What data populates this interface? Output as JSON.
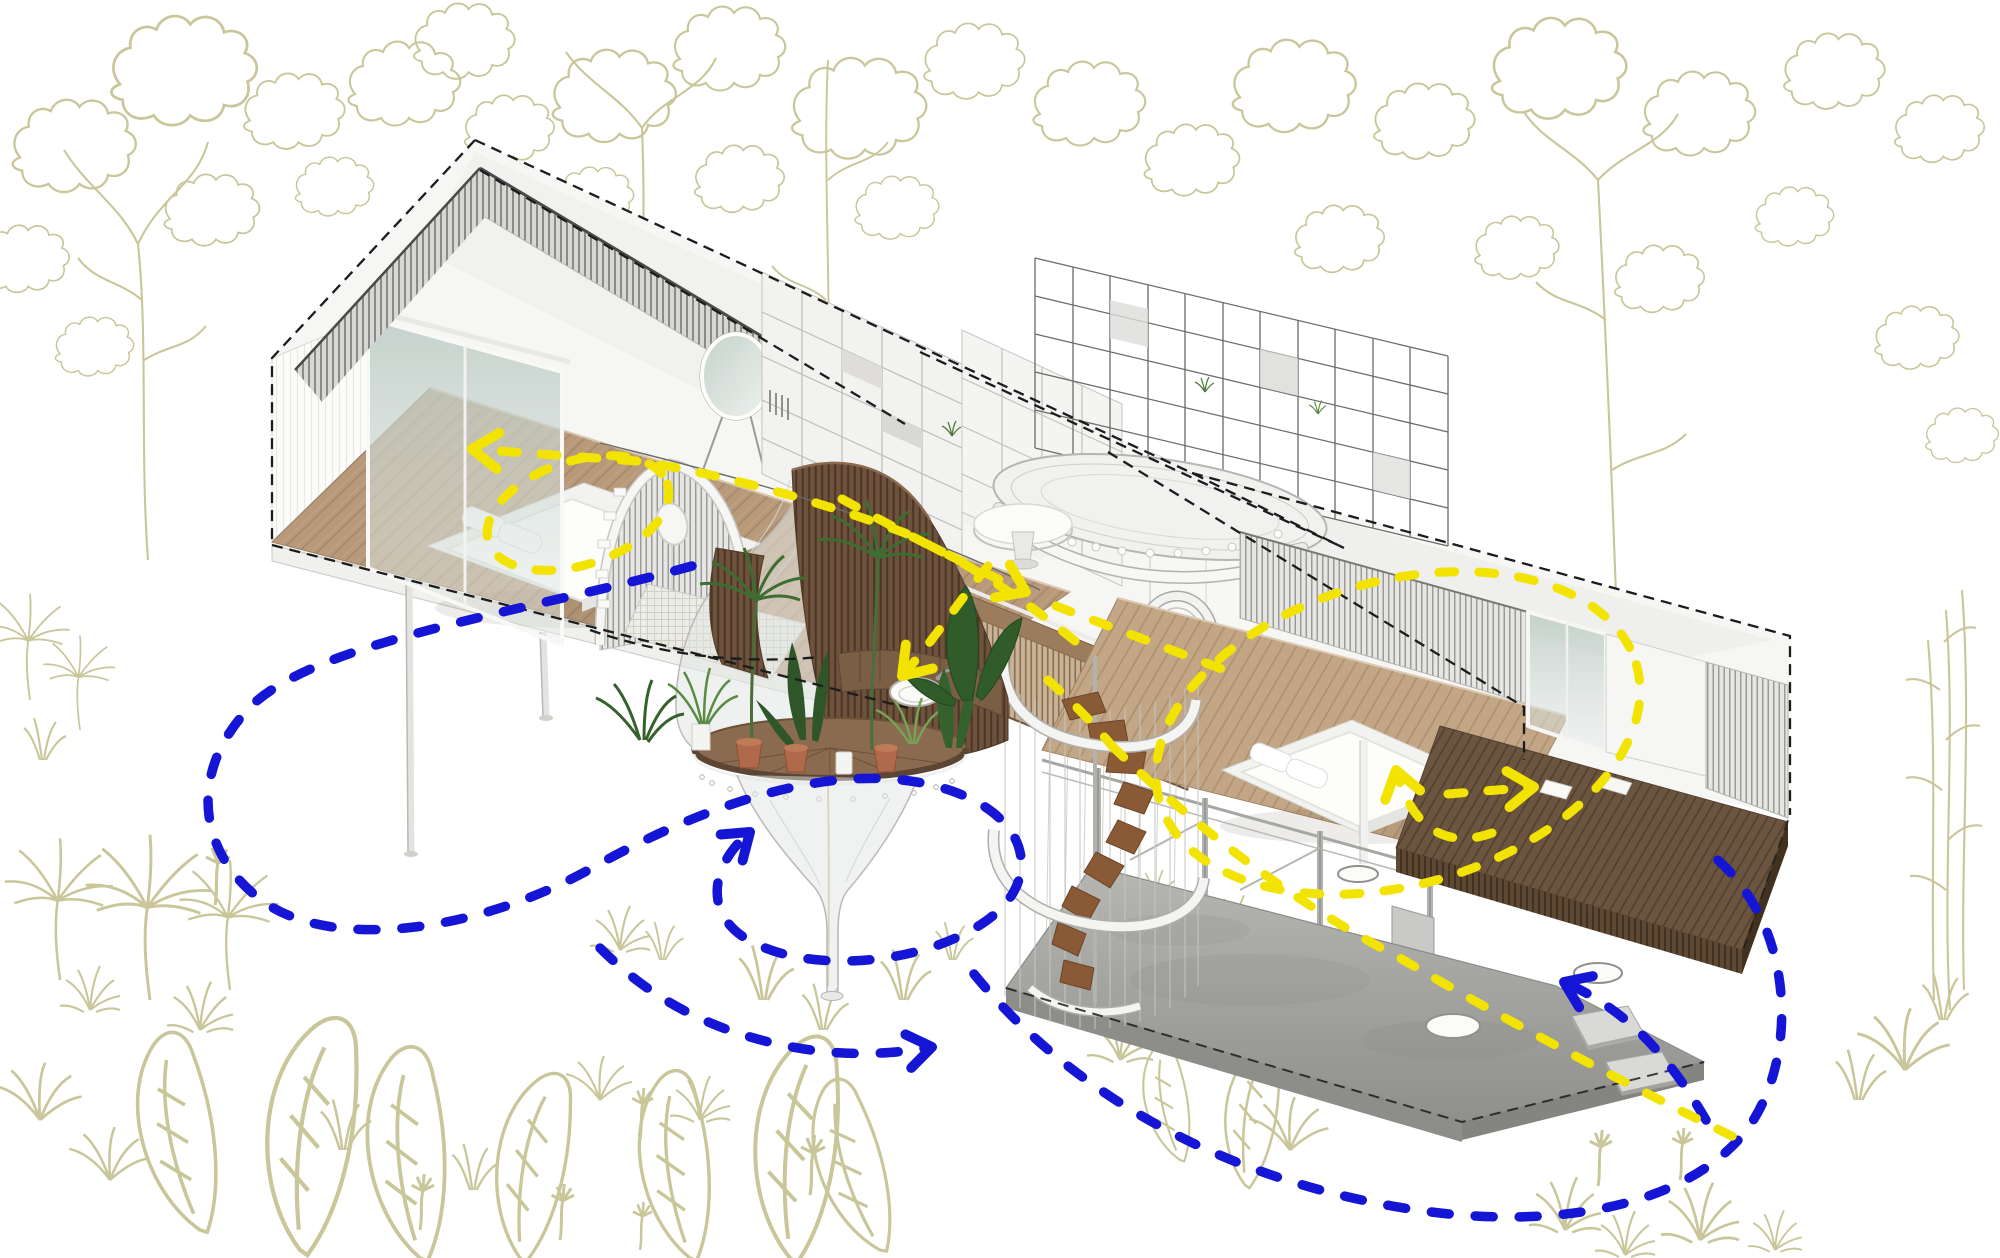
{
  "meta": {
    "domain": "architectural-axonometric-diagram",
    "description": "Axonometric cutaway of a two-wing tropical stilt house in a line-drawn forest, with dashed circulation and airflow paths"
  },
  "colors": {
    "background": "#ffffff",
    "foliage": "#c9c69a",
    "circulation": "#f2e400",
    "airflow": "#1515d6",
    "cut_outline": "#1c1c1c",
    "wall": "#f5f5f4",
    "glass": "#c9d6d0",
    "floor_wood": "#b89a7b",
    "floor_wood_right": "#c2a685",
    "deck_dark": "#6b5540",
    "slat_wood": "#6e523c",
    "fence_wood": "#c9b295",
    "concrete": "#a9a9a6",
    "plant_dark": "#2e5628",
    "plant_mid": "#4c7c3a",
    "plant_light": "#76a355",
    "terracotta": "#b06a4b",
    "stair_tread": "#8a5a36",
    "metal": "#6b6b68"
  },
  "arrows": {
    "circulation": {
      "color": "#f2e400",
      "style": "dashed",
      "arrowhead_count": 5
    },
    "airflow": {
      "color": "#1515d6",
      "style": "dashed",
      "arrowhead_count": 3
    }
  },
  "components": [
    "background-forest",
    "left-bedroom-wing",
    "right-bedroom-wing",
    "central-core-shelving",
    "steel-grid-frame",
    "net-lounge",
    "round-mirror",
    "arched-slat-door",
    "sliding-glass-door",
    "slat-bridge",
    "ring-window",
    "funnel-planter",
    "potted-plants",
    "washbasin",
    "spiral-staircase",
    "round-table",
    "bed",
    "outdoor-deck",
    "concrete-ground-slab",
    "stepping-stones",
    "stilt-columns"
  ]
}
